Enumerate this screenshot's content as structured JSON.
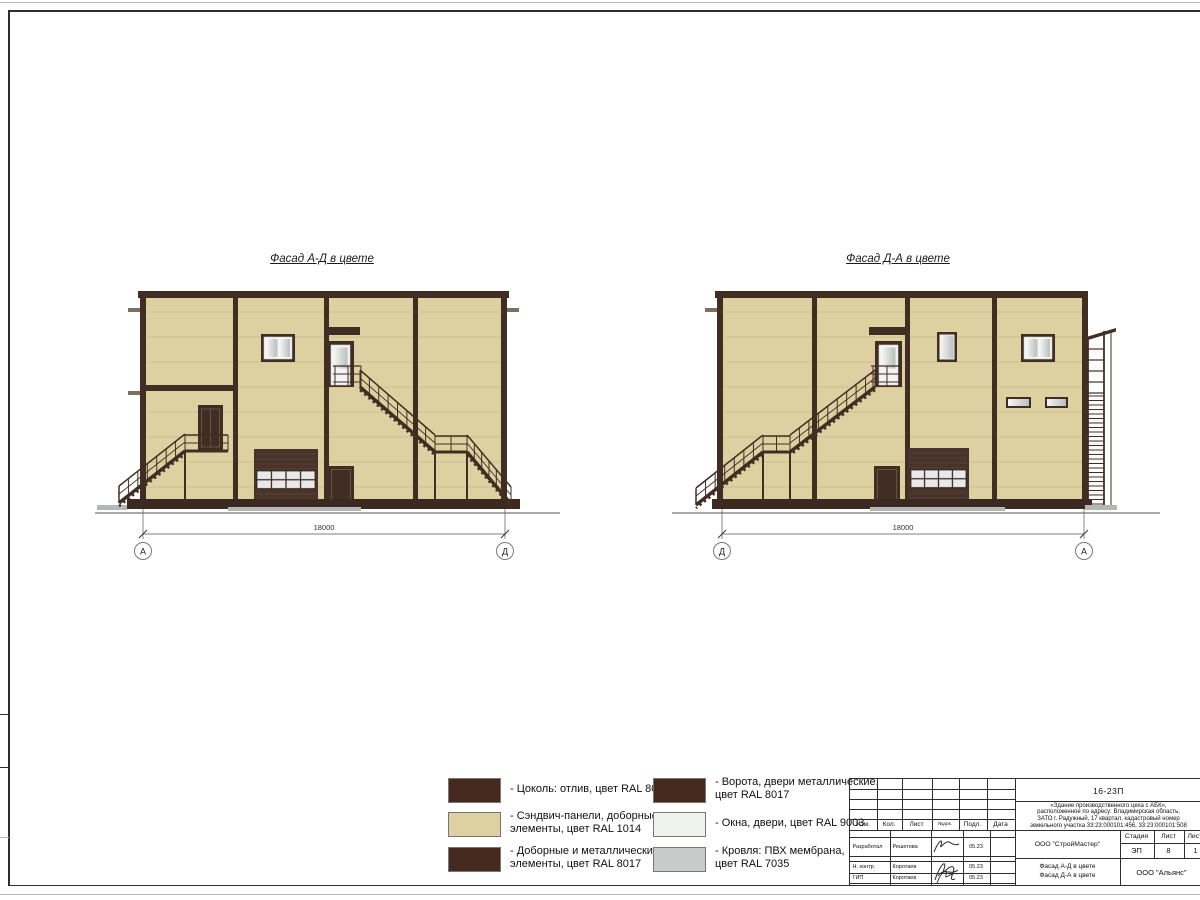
{
  "sheet": {
    "titles": {
      "left": "Фасад А-Д в цвете",
      "right": "Фасад Д-А в цвете"
    },
    "facades": {
      "left": {
        "dim": "18000",
        "axis_left": "А",
        "axis_right": "Д"
      },
      "right": {
        "dim": "18000",
        "axis_left": "Д",
        "axis_right": "А"
      }
    },
    "colors": {
      "wall": "#ddd1a2",
      "trim": "#422d23",
      "plinth": "#3c2920",
      "glass": "#eef3ee",
      "roof": "#c7cbca"
    }
  },
  "legend": {
    "items": [
      {
        "color": "#45291e",
        "lines": [
          "- Цоколь: отлив, цвет RAL 8017",
          ""
        ]
      },
      {
        "color": "#ddd1a2",
        "lines": [
          "- Сэндвич-панели, доборные",
          "элементы, цвет RAL 1014"
        ]
      },
      {
        "color": "#45291e",
        "lines": [
          "- Доборные и металлические",
          "элементы, цвет RAL 8017"
        ]
      },
      {
        "color": "#45291e",
        "lines": [
          "- Ворота, двери металлические,",
          "цвет RAL 8017"
        ]
      },
      {
        "color": "#eef3ee",
        "lines": [
          "- Окна, двери, цвет RAL 9003",
          ""
        ]
      },
      {
        "color": "#c7cbca",
        "lines": [
          "- Кровля: ПВХ мембрана,",
          "цвет RAL 7035"
        ]
      }
    ]
  },
  "title_block": {
    "doc_number": "16-23П",
    "project_lines": [
      "«Здание производственного цеха с АБК»,",
      "расположенное по адресу: Владимирская область,",
      "ЗАТО г. Радужный, 17 квартал, кадастровый номер",
      "земельного участка 33:23:000101:456, 33:23:000101:508"
    ],
    "columns_header": [
      "Изм.",
      "Кол.",
      "Лист",
      "№док.",
      "Подл.",
      "Дата"
    ],
    "company": "ООО \"СтройМастер\"",
    "stage_header": [
      "Стадия",
      "Лист",
      "Листов"
    ],
    "stage": "ЭП",
    "sheet_no": "8",
    "sheets_total": "1",
    "subtitle_line1": "Фасад А-Д в цвете",
    "subtitle_line2": "Фасад Д-А в цвете",
    "org": "ООО \"Альянс\"",
    "people": [
      {
        "role": "Разработал",
        "name": "Решетова",
        "date": "05.23"
      },
      {
        "role": "Н. контр.",
        "name": "Коротаев",
        "date": "05.23"
      },
      {
        "role": "ГИП",
        "name": "Коротаев",
        "date": "05.23"
      }
    ]
  }
}
